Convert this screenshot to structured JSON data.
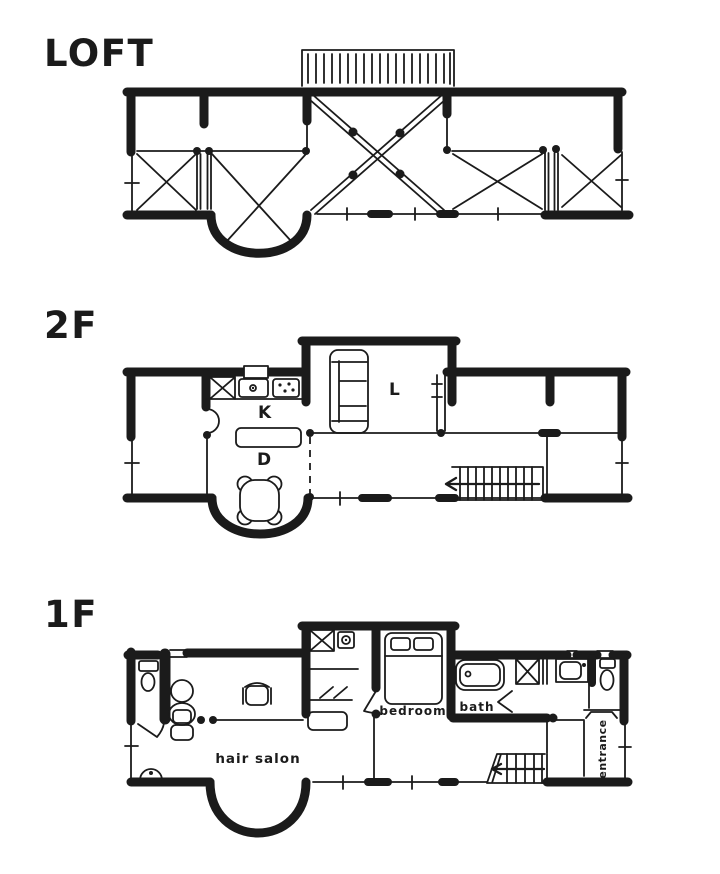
{
  "colors": {
    "ink": "#1b1b1b",
    "paper": "#ffffff"
  },
  "floors": {
    "loft": {
      "label": "LOFT"
    },
    "second": {
      "label": "2F",
      "rooms": {
        "kitchen": "K",
        "dining": "D",
        "living": "L"
      }
    },
    "first": {
      "label": "1F",
      "rooms": {
        "bedroom": "bedroom",
        "bath": "bath",
        "hair_salon": "hair salon",
        "entrance": "entrance"
      }
    }
  }
}
